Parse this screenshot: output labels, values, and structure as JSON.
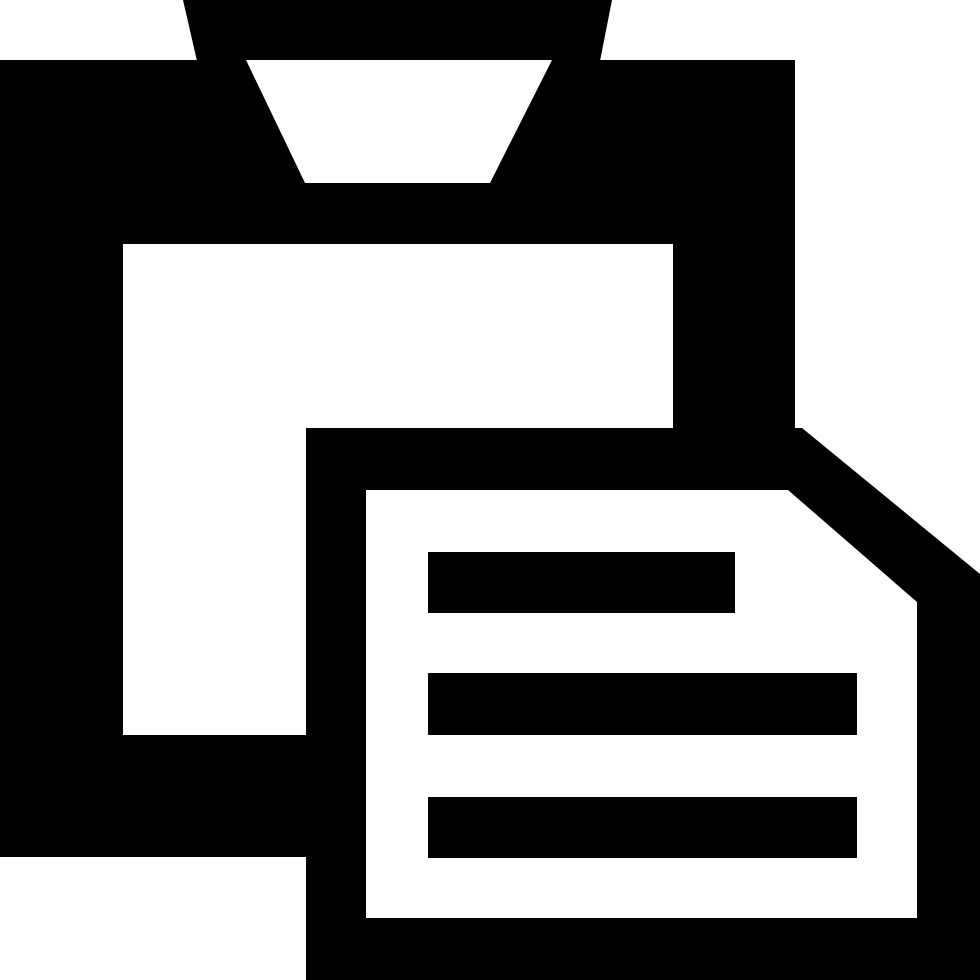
{
  "canvas": {
    "width": 980,
    "height": 980,
    "background_color": "#ffffff"
  },
  "icon": {
    "name": "paste-clipboard-with-document",
    "description": "Black clipboard icon with clip tab at top and an overlapping document page with folded corner and three text lines",
    "foreground_color": "#000000",
    "background_color": "#ffffff",
    "document_text_line_count": 3
  }
}
